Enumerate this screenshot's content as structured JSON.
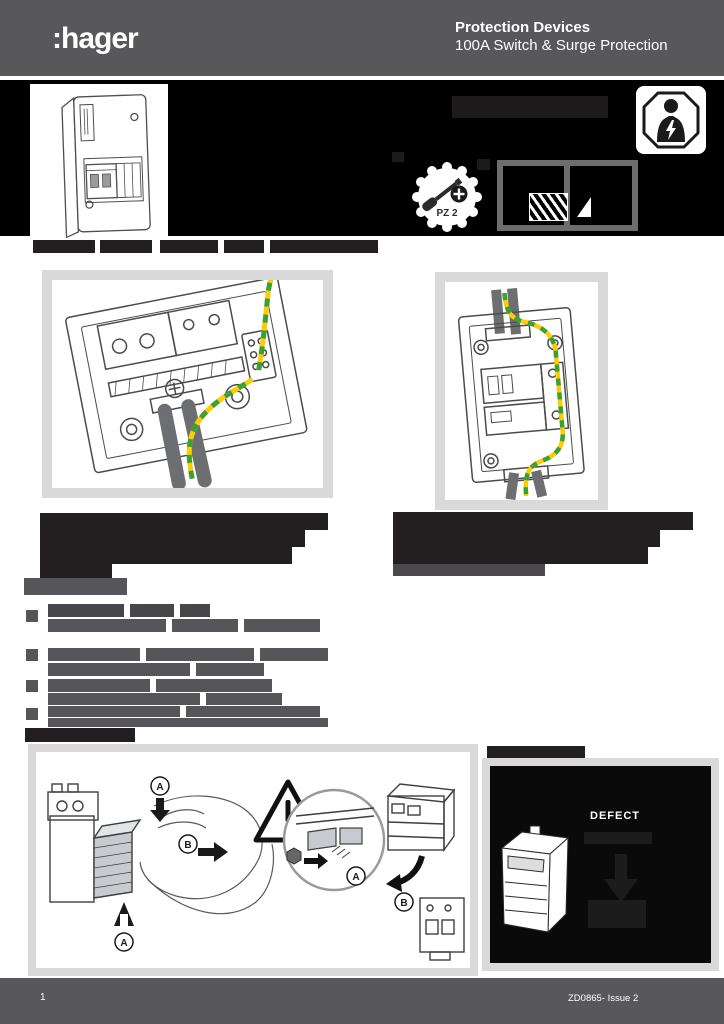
{
  "header": {
    "logo": ":hager",
    "title": "Protection Devices",
    "subtitle": "100A Switch & Surge Protection"
  },
  "footer": {
    "page_number": "1",
    "doc_ref": "ZD0865- Issue 2"
  },
  "tools": {
    "screwdriver_label": "PZ 2"
  },
  "status": {
    "defect_label": "DEFECT"
  },
  "colors": {
    "header_gray": "#58585a",
    "band_black": "#000000",
    "redaction_dark": "#231f20",
    "figure_border": "#d9d9d9",
    "cable_gray": "#6d6e71",
    "earth_yellow": "#ffcb05",
    "earth_green": "#3ba135"
  },
  "redaction_colors": {
    "dark": "#231f20",
    "band_dark": "#1d1a1b",
    "gray": "#55555a",
    "grayb": "#46464b",
    "faint": "#4a4a4e",
    "sub": "#1c1c1c"
  },
  "redactions": [
    {
      "x": 452,
      "y": 96,
      "w": 156,
      "h": 22,
      "c": "band_dark"
    },
    {
      "x": 392,
      "y": 152,
      "w": 12,
      "h": 10,
      "c": "band_dark"
    },
    {
      "x": 477,
      "y": 159,
      "w": 13,
      "h": 11,
      "c": "band_dark"
    },
    {
      "x": 33,
      "y": 240,
      "w": 62,
      "h": 13,
      "c": "dark"
    },
    {
      "x": 100,
      "y": 240,
      "w": 52,
      "h": 13,
      "c": "dark"
    },
    {
      "x": 160,
      "y": 240,
      "w": 58,
      "h": 13,
      "c": "dark"
    },
    {
      "x": 224,
      "y": 240,
      "w": 40,
      "h": 13,
      "c": "dark"
    },
    {
      "x": 270,
      "y": 240,
      "w": 108,
      "h": 13,
      "c": "dark"
    },
    {
      "x": 40,
      "y": 513,
      "w": 288,
      "h": 17,
      "c": "dark"
    },
    {
      "x": 40,
      "y": 530,
      "w": 265,
      "h": 17,
      "c": "dark"
    },
    {
      "x": 40,
      "y": 547,
      "w": 252,
      "h": 17,
      "c": "dark"
    },
    {
      "x": 40,
      "y": 564,
      "w": 72,
      "h": 15,
      "c": "dark"
    },
    {
      "x": 393,
      "y": 512,
      "w": 300,
      "h": 18,
      "c": "dark"
    },
    {
      "x": 393,
      "y": 530,
      "w": 267,
      "h": 17,
      "c": "dark"
    },
    {
      "x": 393,
      "y": 547,
      "w": 255,
      "h": 17,
      "c": "dark"
    },
    {
      "x": 393,
      "y": 564,
      "w": 152,
      "h": 12,
      "c": "faint"
    },
    {
      "x": 24,
      "y": 578,
      "w": 103,
      "h": 17,
      "c": "gray"
    },
    {
      "x": 26,
      "y": 610,
      "w": 12,
      "h": 12,
      "c": "gray"
    },
    {
      "x": 26,
      "y": 649,
      "w": 12,
      "h": 12,
      "c": "gray"
    },
    {
      "x": 26,
      "y": 680,
      "w": 12,
      "h": 12,
      "c": "gray"
    },
    {
      "x": 26,
      "y": 708,
      "w": 12,
      "h": 12,
      "c": "gray"
    },
    {
      "x": 48,
      "y": 604,
      "w": 76,
      "h": 13,
      "c": "grayb"
    },
    {
      "x": 130,
      "y": 604,
      "w": 44,
      "h": 13,
      "c": "grayb"
    },
    {
      "x": 180,
      "y": 604,
      "w": 30,
      "h": 13,
      "c": "grayb"
    },
    {
      "x": 48,
      "y": 619,
      "w": 118,
      "h": 13,
      "c": "gray"
    },
    {
      "x": 172,
      "y": 619,
      "w": 66,
      "h": 13,
      "c": "gray"
    },
    {
      "x": 244,
      "y": 619,
      "w": 76,
      "h": 13,
      "c": "gray"
    },
    {
      "x": 48,
      "y": 648,
      "w": 92,
      "h": 13,
      "c": "gray"
    },
    {
      "x": 146,
      "y": 648,
      "w": 108,
      "h": 13,
      "c": "gray"
    },
    {
      "x": 260,
      "y": 648,
      "w": 68,
      "h": 13,
      "c": "gray"
    },
    {
      "x": 48,
      "y": 663,
      "w": 142,
      "h": 13,
      "c": "gray"
    },
    {
      "x": 196,
      "y": 663,
      "w": 68,
      "h": 13,
      "c": "gray"
    },
    {
      "x": 48,
      "y": 679,
      "w": 102,
      "h": 13,
      "c": "gray"
    },
    {
      "x": 156,
      "y": 679,
      "w": 116,
      "h": 13,
      "c": "gray"
    },
    {
      "x": 48,
      "y": 693,
      "w": 152,
      "h": 12,
      "c": "gray"
    },
    {
      "x": 206,
      "y": 693,
      "w": 76,
      "h": 12,
      "c": "gray"
    },
    {
      "x": 48,
      "y": 706,
      "w": 132,
      "h": 11,
      "c": "gray"
    },
    {
      "x": 186,
      "y": 706,
      "w": 134,
      "h": 11,
      "c": "gray"
    },
    {
      "x": 48,
      "y": 718,
      "w": 280,
      "h": 9,
      "c": "gray"
    },
    {
      "x": 25,
      "y": 728,
      "w": 110,
      "h": 14,
      "c": "dark"
    },
    {
      "x": 487,
      "y": 746,
      "w": 98,
      "h": 12,
      "c": "dark"
    },
    {
      "x": 584,
      "y": 832,
      "w": 68,
      "h": 12,
      "c": "sub"
    },
    {
      "x": 588,
      "y": 900,
      "w": 58,
      "h": 28,
      "c": "sub"
    }
  ]
}
